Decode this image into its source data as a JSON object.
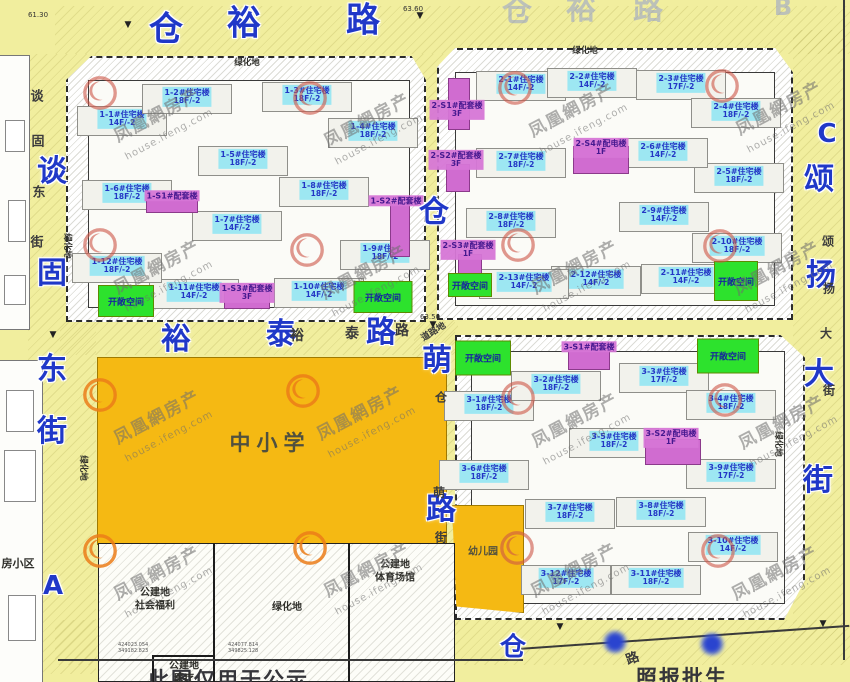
{
  "watermark": {
    "brand": "凤凰網房产",
    "site": "house.ifeng.com",
    "units": [
      {
        "x": 100,
        "y": 95,
        "v": "red"
      },
      {
        "x": 310,
        "y": 100,
        "v": "red"
      },
      {
        "x": 515,
        "y": 90,
        "v": "red"
      },
      {
        "x": 722,
        "y": 88,
        "v": "red"
      },
      {
        "x": 100,
        "y": 247,
        "v": "red"
      },
      {
        "x": 307,
        "y": 252,
        "v": "red"
      },
      {
        "x": 518,
        "y": 247,
        "v": "red"
      },
      {
        "x": 720,
        "y": 248,
        "v": "red"
      },
      {
        "x": 100,
        "y": 397,
        "v": "orange"
      },
      {
        "x": 303,
        "y": 393,
        "v": "orange"
      },
      {
        "x": 518,
        "y": 400,
        "v": "red"
      },
      {
        "x": 725,
        "y": 402,
        "v": "red"
      },
      {
        "x": 100,
        "y": 553,
        "v": "orange"
      },
      {
        "x": 310,
        "y": 550,
        "v": "orange"
      },
      {
        "x": 517,
        "y": 550,
        "v": "red"
      },
      {
        "x": 718,
        "y": 553,
        "v": "red"
      }
    ]
  },
  "disclaimer": {
    "part1": "此图仅用于公示",
    "part2": "照报批生"
  },
  "land": {
    "school": "中小学",
    "kindergarten": "幼儿园",
    "green": "绿化地",
    "open": "开敞空间",
    "road_land": "道路地",
    "neighborhood": "房小区",
    "parcels": [
      {
        "l1": "公建地",
        "l2": "社会福利",
        "x": 155,
        "y": 600
      },
      {
        "l1": "绿化地",
        "l2": "",
        "x": 287,
        "y": 608
      },
      {
        "l1": "公建地",
        "l2": "体育场馆",
        "x": 395,
        "y": 572
      },
      {
        "l1": "公建地",
        "l2": "医疗",
        "x": 184,
        "y": 673
      }
    ],
    "green_labels": [
      {
        "x": 247,
        "y": 62,
        "rot": 0
      },
      {
        "x": 585,
        "y": 50,
        "rot": 0
      },
      {
        "x": 68,
        "y": 246,
        "rot": 90
      },
      {
        "x": 84,
        "y": 468,
        "rot": 90
      },
      {
        "x": 779,
        "y": 444,
        "rot": 90
      }
    ],
    "open_spaces": [
      {
        "x": 126,
        "y": 301,
        "w": 54,
        "h": 30
      },
      {
        "x": 383,
        "y": 297,
        "w": 57,
        "h": 30
      },
      {
        "x": 470,
        "y": 285,
        "w": 42,
        "h": 22
      },
      {
        "x": 736,
        "y": 281,
        "w": 42,
        "h": 38
      },
      {
        "x": 483,
        "y": 358,
        "w": 54,
        "h": 33
      },
      {
        "x": 728,
        "y": 356,
        "w": 60,
        "h": 33
      }
    ]
  },
  "buildings": {
    "residential": [
      {
        "name": "1-1#住宅楼",
        "floors": "14F/-2",
        "x": 122,
        "y": 119
      },
      {
        "name": "1-2#住宅楼",
        "floors": "18F/-2",
        "x": 187,
        "y": 97
      },
      {
        "name": "1-3#住宅楼",
        "floors": "18F/-2",
        "x": 307,
        "y": 95
      },
      {
        "name": "1-4#住宅楼",
        "floors": "18F/-2",
        "x": 373,
        "y": 131
      },
      {
        "name": "1-5#住宅楼",
        "floors": "18F/-2",
        "x": 243,
        "y": 159
      },
      {
        "name": "1-6#住宅楼",
        "floors": "18F/-2",
        "x": 127,
        "y": 193
      },
      {
        "name": "1-7#住宅楼",
        "floors": "14F/-2",
        "x": 237,
        "y": 224
      },
      {
        "name": "1-8#住宅楼",
        "floors": "18F/-2",
        "x": 324,
        "y": 190
      },
      {
        "name": "1-9#住宅楼",
        "floors": "18F/-2",
        "x": 385,
        "y": 253
      },
      {
        "name": "1-10#住宅楼",
        "floors": "14F/-2",
        "x": 319,
        "y": 291
      },
      {
        "name": "1-11#住宅楼",
        "floors": "14F/-2",
        "x": 194,
        "y": 292
      },
      {
        "name": "1-12#住宅楼",
        "floors": "18F/-2",
        "x": 117,
        "y": 266
      },
      {
        "name": "2-1#住宅楼",
        "floors": "14F/-2",
        "x": 521,
        "y": 84
      },
      {
        "name": "2-2#住宅楼",
        "floors": "14F/-2",
        "x": 592,
        "y": 81
      },
      {
        "name": "2-3#住宅楼",
        "floors": "17F/-2",
        "x": 681,
        "y": 83
      },
      {
        "name": "2-4#住宅楼",
        "floors": "18F/-2",
        "x": 736,
        "y": 111
      },
      {
        "name": "2-5#住宅楼",
        "floors": "18F/-2",
        "x": 739,
        "y": 176
      },
      {
        "name": "2-6#住宅楼",
        "floors": "14F/-2",
        "x": 663,
        "y": 151
      },
      {
        "name": "2-7#住宅楼",
        "floors": "18F/-2",
        "x": 521,
        "y": 161
      },
      {
        "name": "2-8#住宅楼",
        "floors": "18F/-2",
        "x": 511,
        "y": 221
      },
      {
        "name": "2-9#住宅楼",
        "floors": "14F/-2",
        "x": 664,
        "y": 215
      },
      {
        "name": "2-10#住宅楼",
        "floors": "18F/-2",
        "x": 737,
        "y": 246
      },
      {
        "name": "2-11#住宅楼",
        "floors": "14F/-2",
        "x": 686,
        "y": 277
      },
      {
        "name": "2-12#住宅楼",
        "floors": "14F/-2",
        "x": 596,
        "y": 279
      },
      {
        "name": "2-13#住宅楼",
        "floors": "14F/-2",
        "x": 524,
        "y": 282
      },
      {
        "name": "3-1#住宅楼",
        "floors": "18F/-2",
        "x": 489,
        "y": 404
      },
      {
        "name": "3-2#住宅楼",
        "floors": "18F/-2",
        "x": 556,
        "y": 384
      },
      {
        "name": "3-3#住宅楼",
        "floors": "17F/-2",
        "x": 664,
        "y": 376
      },
      {
        "name": "3-4#住宅楼",
        "floors": "18F/-2",
        "x": 731,
        "y": 403
      },
      {
        "name": "3-5#住宅楼",
        "floors": "18F/-2",
        "x": 614,
        "y": 441
      },
      {
        "name": "3-6#住宅楼",
        "floors": "18F/-2",
        "x": 484,
        "y": 473
      },
      {
        "name": "3-7#住宅楼",
        "floors": "18F/-2",
        "x": 570,
        "y": 512
      },
      {
        "name": "3-8#住宅楼",
        "floors": "18F/-2",
        "x": 661,
        "y": 510
      },
      {
        "name": "3-9#住宅楼",
        "floors": "17F/-2",
        "x": 731,
        "y": 472
      },
      {
        "name": "3-10#住宅楼",
        "floors": "14F/-2",
        "x": 733,
        "y": 545
      },
      {
        "name": "3-11#住宅楼",
        "floors": "18F/-2",
        "x": 656,
        "y": 578
      },
      {
        "name": "3-12#住宅楼",
        "floors": "17F/-2",
        "x": 566,
        "y": 578
      }
    ],
    "support": [
      {
        "name": "1-S1#配套楼",
        "floors": "",
        "x": 172,
        "y": 196,
        "rect": [
          172,
          204,
          50,
          16
        ]
      },
      {
        "name": "1-S2#配套楼",
        "floors": "",
        "x": 396,
        "y": 201,
        "rect": [
          400,
          230,
          18,
          52
        ]
      },
      {
        "name": "1-S3#配套楼",
        "floors": "3F",
        "x": 247,
        "y": 293,
        "rect": [
          247,
          300,
          44,
          16
        ]
      },
      {
        "name": "2-S1#配套楼",
        "floors": "3F",
        "x": 457,
        "y": 110,
        "rect": [
          459,
          104,
          20,
          50
        ]
      },
      {
        "name": "2-S2#配套楼",
        "floors": "3F",
        "x": 456,
        "y": 160,
        "rect": [
          458,
          178,
          22,
          26
        ]
      },
      {
        "name": "2-S3#配套楼",
        "floors": "1F",
        "x": 468,
        "y": 250,
        "rect": [
          470,
          264,
          22,
          18
        ]
      },
      {
        "name": "2-S4#配电楼",
        "floors": "1F",
        "x": 601,
        "y": 148,
        "rect": [
          601,
          160,
          54,
          26
        ]
      },
      {
        "name": "3-S1#配套楼",
        "floors": "",
        "x": 589,
        "y": 347,
        "rect": [
          589,
          360,
          40,
          18
        ]
      },
      {
        "name": "3-S2#配电楼",
        "floors": "1F",
        "x": 671,
        "y": 438,
        "rect": [
          673,
          452,
          54,
          24
        ]
      }
    ]
  },
  "streets": {
    "top_big": [
      {
        "ch": "仓",
        "x": 166,
        "y": 26
      },
      {
        "ch": "裕",
        "x": 244,
        "y": 20
      },
      {
        "ch": "路",
        "x": 363,
        "y": 17
      }
    ],
    "top_faint": [
      {
        "ch": "仓",
        "x": 517,
        "y": 8
      },
      {
        "ch": "裕",
        "x": 581,
        "y": 6
      },
      {
        "ch": "路",
        "x": 648,
        "y": 6
      }
    ],
    "left_big": [
      {
        "ch": "谈",
        "x": 52,
        "y": 168
      },
      {
        "ch": "固",
        "x": 52,
        "y": 270
      },
      {
        "ch": "东",
        "x": 52,
        "y": 366
      },
      {
        "ch": "街",
        "x": 52,
        "y": 428
      }
    ],
    "left_small": [
      {
        "ch": "谈",
        "x": 37,
        "y": 95
      },
      {
        "ch": "固",
        "x": 38,
        "y": 140
      },
      {
        "ch": "东",
        "x": 39,
        "y": 191
      },
      {
        "ch": "街",
        "x": 37,
        "y": 241
      }
    ],
    "mid_big": [
      {
        "ch": "裕",
        "x": 176,
        "y": 336
      },
      {
        "ch": "泰",
        "x": 281,
        "y": 331
      },
      {
        "ch": "路",
        "x": 381,
        "y": 329
      }
    ],
    "mid_small": [
      {
        "ch": "裕",
        "x": 297,
        "y": 335
      },
      {
        "ch": "泰",
        "x": 352,
        "y": 333
      },
      {
        "ch": "路",
        "x": 402,
        "y": 330
      }
    ],
    "center_big": [
      {
        "ch": "仓",
        "x": 434,
        "y": 209
      },
      {
        "ch": "萌",
        "x": 437,
        "y": 357
      },
      {
        "ch": "路",
        "x": 441,
        "y": 506
      }
    ],
    "center_small": [
      {
        "ch": "仓",
        "x": 441,
        "y": 397
      },
      {
        "ch": "萌",
        "x": 439,
        "y": 492
      },
      {
        "ch": "街",
        "x": 441,
        "y": 537
      }
    ],
    "right_big": [
      {
        "ch": "颂",
        "x": 819,
        "y": 176
      },
      {
        "ch": "扬",
        "x": 821,
        "y": 272
      },
      {
        "ch": "大",
        "x": 819,
        "y": 371
      },
      {
        "ch": "街",
        "x": 818,
        "y": 477
      }
    ],
    "right_small": [
      {
        "ch": "颂",
        "x": 828,
        "y": 241
      },
      {
        "ch": "扬",
        "x": 829,
        "y": 288
      },
      {
        "ch": "大",
        "x": 826,
        "y": 333
      },
      {
        "ch": "街",
        "x": 829,
        "y": 390
      }
    ],
    "bottom_big": [
      {
        "ch": "仓",
        "x": 513,
        "y": 645
      }
    ],
    "bottom_small": [
      {
        "ch": "路",
        "x": 632,
        "y": 657
      }
    ]
  },
  "markers": [
    {
      "t": "A",
      "x": 53,
      "y": 586,
      "faint": false
    },
    {
      "t": "B",
      "x": 783,
      "y": 7,
      "faint": true
    },
    {
      "t": "C",
      "x": 827,
      "y": 134,
      "faint": false
    }
  ],
  "elevations": [
    {
      "t": "61.30",
      "x": 38,
      "y": 15
    },
    {
      "t": "63.60",
      "x": 413,
      "y": 9
    },
    {
      "t": "63.50",
      "x": 430,
      "y": 317
    }
  ],
  "coords_small": [
    {
      "t": "424023.054\n349182.823",
      "x": 118,
      "y": 642
    },
    {
      "t": "424077.814\n349825.128",
      "x": 228,
      "y": 642
    }
  ],
  "arrows": [
    {
      "x": 128,
      "y": 25
    },
    {
      "x": 420,
      "y": 16
    },
    {
      "x": 433,
      "y": 325
    },
    {
      "x": 53,
      "y": 335
    },
    {
      "x": 823,
      "y": 624
    },
    {
      "x": 560,
      "y": 627
    }
  ],
  "censor_dots": [
    {
      "x": 615,
      "y": 642
    },
    {
      "x": 712,
      "y": 644
    }
  ]
}
